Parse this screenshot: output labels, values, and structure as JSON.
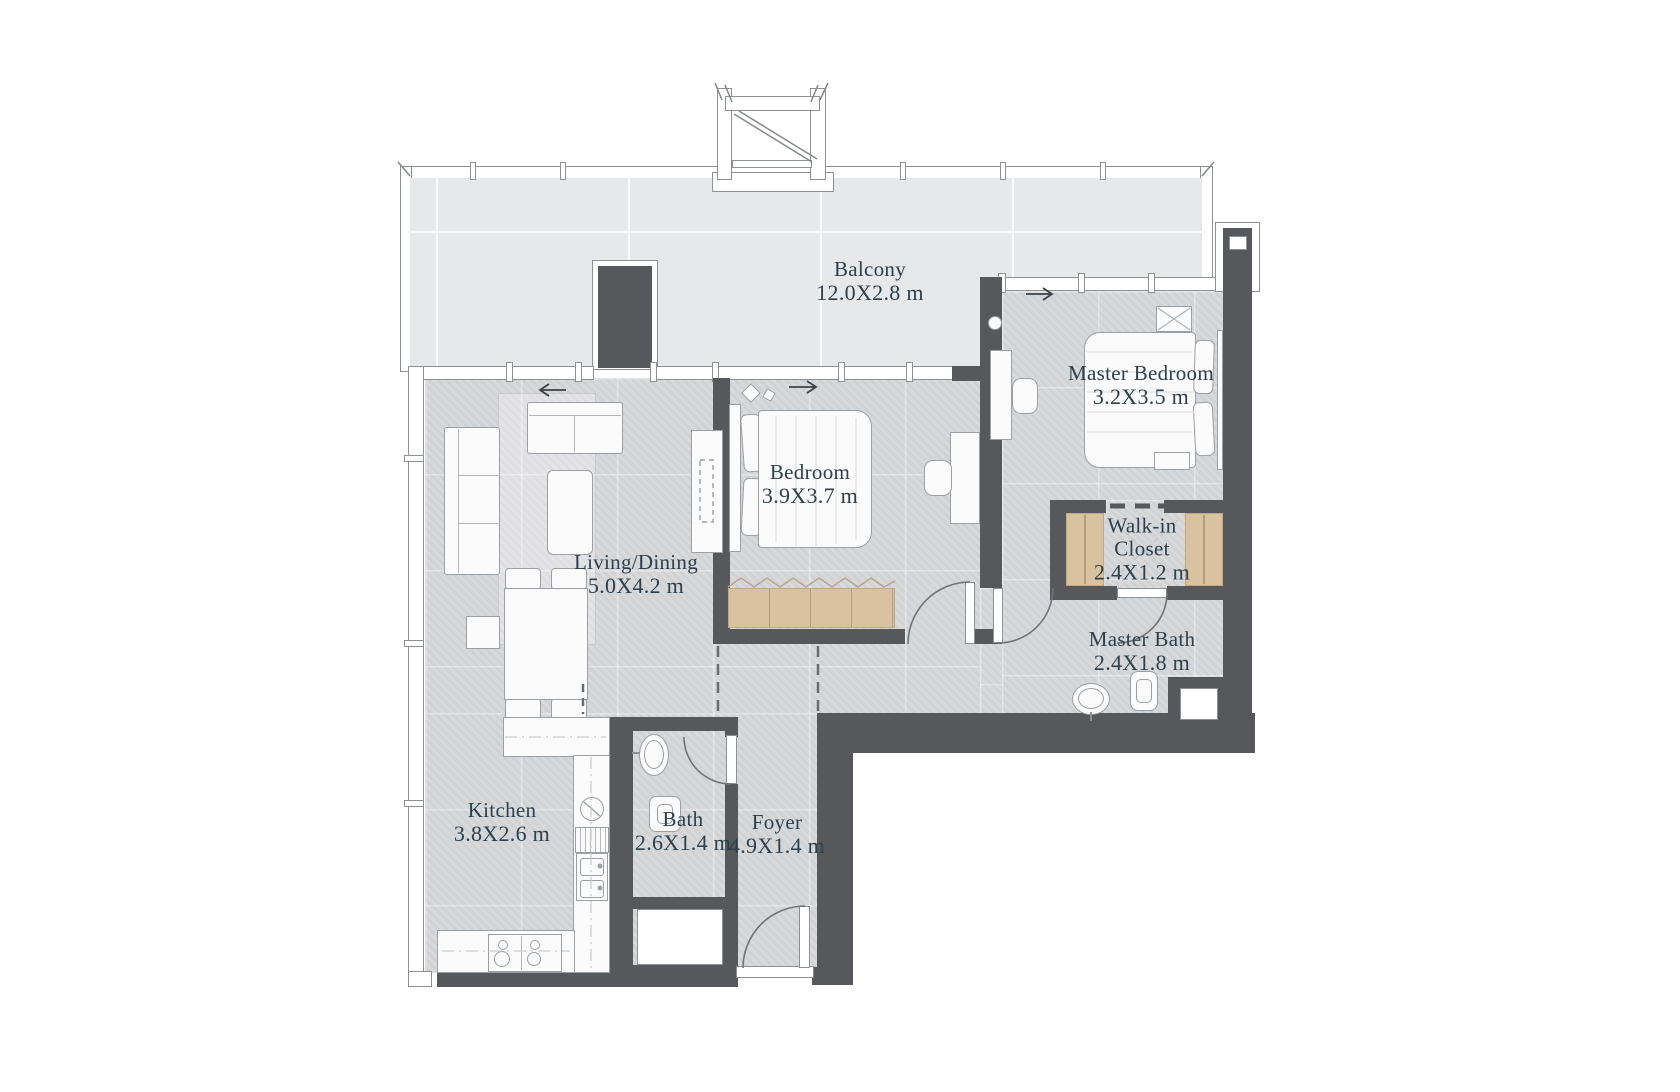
{
  "plan_type": "apartment-floor-plan",
  "colors": {
    "wall": "#57585c",
    "floor": "#d6d7d9",
    "balcony": "#e7e8ea",
    "wood": "#d9c2a0",
    "label": "#2c404e"
  },
  "rooms": [
    {
      "id": "balcony",
      "name": "Balcony",
      "dims": "12.0X2.8 m"
    },
    {
      "id": "living-dining",
      "name": "Living/Dining",
      "dims": "5.0X4.2 m"
    },
    {
      "id": "bedroom",
      "name": "Bedroom",
      "dims": "3.9X3.7 m"
    },
    {
      "id": "master-bedroom",
      "name": "Master Bedroom",
      "dims": "3.2X3.5 m"
    },
    {
      "id": "walk-in-closet",
      "name": "Walk-in Closet",
      "dims": "2.4X1.2 m"
    },
    {
      "id": "master-bath",
      "name": "Master Bath",
      "dims": "2.4X1.8 m"
    },
    {
      "id": "kitchen",
      "name": "Kitchen",
      "dims": "3.8X2.6 m"
    },
    {
      "id": "bath",
      "name": "Bath",
      "dims": "2.6X1.4 m"
    },
    {
      "id": "foyer",
      "name": "Foyer",
      "dims": "4.9X1.4 m"
    }
  ]
}
